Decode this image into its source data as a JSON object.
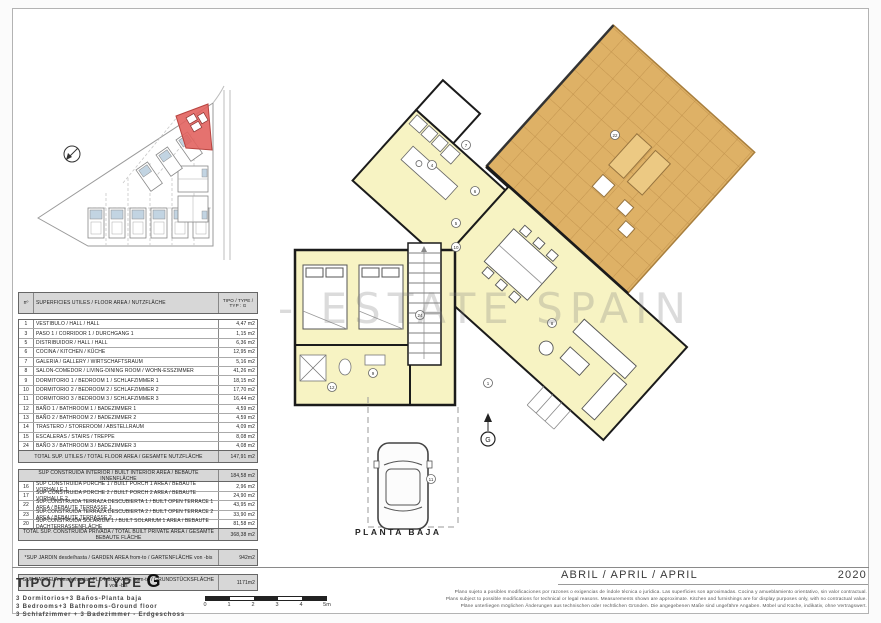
{
  "sheet": {
    "watermark": "- ESTATE SPAIN",
    "plan_label": "PLANTA BAJA",
    "north_marker": "G",
    "footer": {
      "type_title": "TIPO/TYPE/TYPE",
      "type_letter": "G",
      "subtitles": [
        "3 Dormitorios+3 Baños-Planta baja",
        "3 Bedrooms+3 Bathrooms-Ground floor",
        "3 Schlafzimmer + 3 Badezimmer - Erdgeschoss"
      ],
      "date_label": "ABRIL / APRIL / APRIL",
      "date_year": "2020",
      "scale_ticks": [
        "0",
        "1",
        "2",
        "3",
        "4",
        "5m"
      ],
      "disclaimer": [
        "Plano sujeto a posibles modificaciones por razones o exigencias de índole técnica o jurídica. Las superficies son aproximadas. Cocina y amueblamiento orientativo, sin valor contractual.",
        "Plans subject to possible modifications for technical or legal reasons. Measurements shown are approximate. Kitchen and furnishings are for display purposes only, with no contractual value.",
        "Pläne unterliegen möglichen Änderungen aus technischen oder rechtlichen Gründen. Die angegebenen Maße sind ungefähre Angaben. Möbel und Küche, indikativ, ohne Vertragswert."
      ]
    },
    "colors": {
      "room_fill": "#f7f3c3",
      "terrace_fill": "#deb166",
      "terrace_grid": "#c3944e",
      "highlight_plot": "#e2635f",
      "roof_blue": "#c2d4e2"
    }
  },
  "area_table": {
    "header": {
      "num": "nº",
      "label": "SUPERFICIES UTILES / FLOOR AREA / NUTZFLÄCHE",
      "type_line1": "TIPO / TYPE /",
      "type_line2": "TYP : G"
    },
    "rooms": [
      {
        "num": "1",
        "label": "VESTIBULO / HALL / HALL",
        "value": "4,47 m2"
      },
      {
        "num": "3",
        "label": "PASO 1 / CORRIDOR 1 / DURCHGANG 1",
        "value": "1,15 m2"
      },
      {
        "num": "5",
        "label": "DISTRIBUIDOR / HALL / HALL",
        "value": "6,36 m2"
      },
      {
        "num": "6",
        "label": "COCINA / KITCHEN / KÜCHE",
        "value": "12,95 m2"
      },
      {
        "num": "7",
        "label": "GALERIA / GALLERY / WIRTSCHAFTSRAUM",
        "value": "5,16 m2"
      },
      {
        "num": "8",
        "label": "SALON-COMEDOR / LIVING-DINING ROOM / WOHN-ESSZIMMER",
        "value": "41,26 m2"
      },
      {
        "num": "9",
        "label": "DORMITORIO 1 / BEDROOM 1 / SCHLAFZIMMER 1",
        "value": "18,15 m2"
      },
      {
        "num": "10",
        "label": "DORMITORIO 2 / BEDROOM 2 / SCHLAFZIMMER 2",
        "value": "17,70 m2"
      },
      {
        "num": "11",
        "label": "DORMITORIO 3 / BEDROOM 3 / SCHLAFZIMMER 3",
        "value": "16,44 m2"
      },
      {
        "num": "12",
        "label": "BAÑO 1 / BATHROOM 1 / BADEZIMMER 1",
        "value": "4,59 m2"
      },
      {
        "num": "13",
        "label": "BAÑO 2 / BATHROOM 2 / BADEZIMMER 2",
        "value": "4,59 m2"
      },
      {
        "num": "14",
        "label": "TRASTERO / STOREROOM / ABSTELLRAUM",
        "value": "4,09 m2"
      },
      {
        "num": "15",
        "label": "ESCALERAS / STAIRS / TREPPE",
        "value": "8,08 m2"
      },
      {
        "num": "24",
        "label": "BAÑO 3 / BATHROOM 3 / BADEZIMMER 3",
        "value": "4,08 m2"
      }
    ],
    "total_floor": {
      "label": "TOTAL SUP. UTILES / TOTAL FLOOR AREA / GESAMTE NUTZFLÄCHE",
      "value": "147,91 m2"
    },
    "built_interior": {
      "label": "SUP CONSTRUIDA INTERIOR / BUILT INTERIOR AREA / BEBAUTE INNENFLÄCHE",
      "value": "184,58 m2"
    },
    "built_rows": [
      {
        "num": "16",
        "label": "SUP CONSTRUIDA PORCHE 1 / BUILT PORCH 1 AREA / BEBAUTE VORHALLE 1",
        "value": "2,96 m2"
      },
      {
        "num": "17",
        "label": "SUP CONSTRUIDA PORCHE 2 / BUILT PORCH 2 AREA / BEBAUTE VORHALLE 2",
        "value": "24,90 m2"
      },
      {
        "num": "22",
        "label": "SUP.CONSTRUIDA TERRAZA DESCUBIERTA 1 / BUILT OPEN TERRACE 1 AREA / BEBAUTE TERRASSE 1",
        "value": "43,95 m2"
      },
      {
        "num": "23",
        "label": "SUP.CONSTRUIDA TERRAZA DESCUBIERTA 2 / BUILT OPEN TERRACE 2 AREA / BEBAUTE TERRASSE 2",
        "value": "33,90 m2"
      },
      {
        "num": "20",
        "label": "SUP.CONSTRUIDA SOLARIUM 1 / BUILT SOLARIUM 1 AREA / BEBAUTE DACHTERRASSENFLÄCHE",
        "value": "81,58 m2"
      }
    ],
    "total_built": {
      "label": "TOTAL SUP. CONSTRUIDA PRIVADA / TOTAL BUILT PRIVATE AREA / GESAMTE BEBAUTE FLÄCHE",
      "value": "368,38 m2"
    },
    "garden": {
      "label": "*SUP JARDIN desde/hasta / GARDEN AREA from-to / GARTENFLÄCHE von -bis",
      "value": "942m2"
    },
    "plot": {
      "label": "SUP PARCELA desde/hasta / PLOT SURFACE from-to / GRUNDSTÜCKSFLÄCHE von -bis",
      "value": "1171m2"
    }
  },
  "plan_markers": [
    "4",
    "6",
    "5",
    "7",
    "10",
    "1",
    "8",
    "9",
    "12",
    "24",
    "11",
    "22"
  ]
}
